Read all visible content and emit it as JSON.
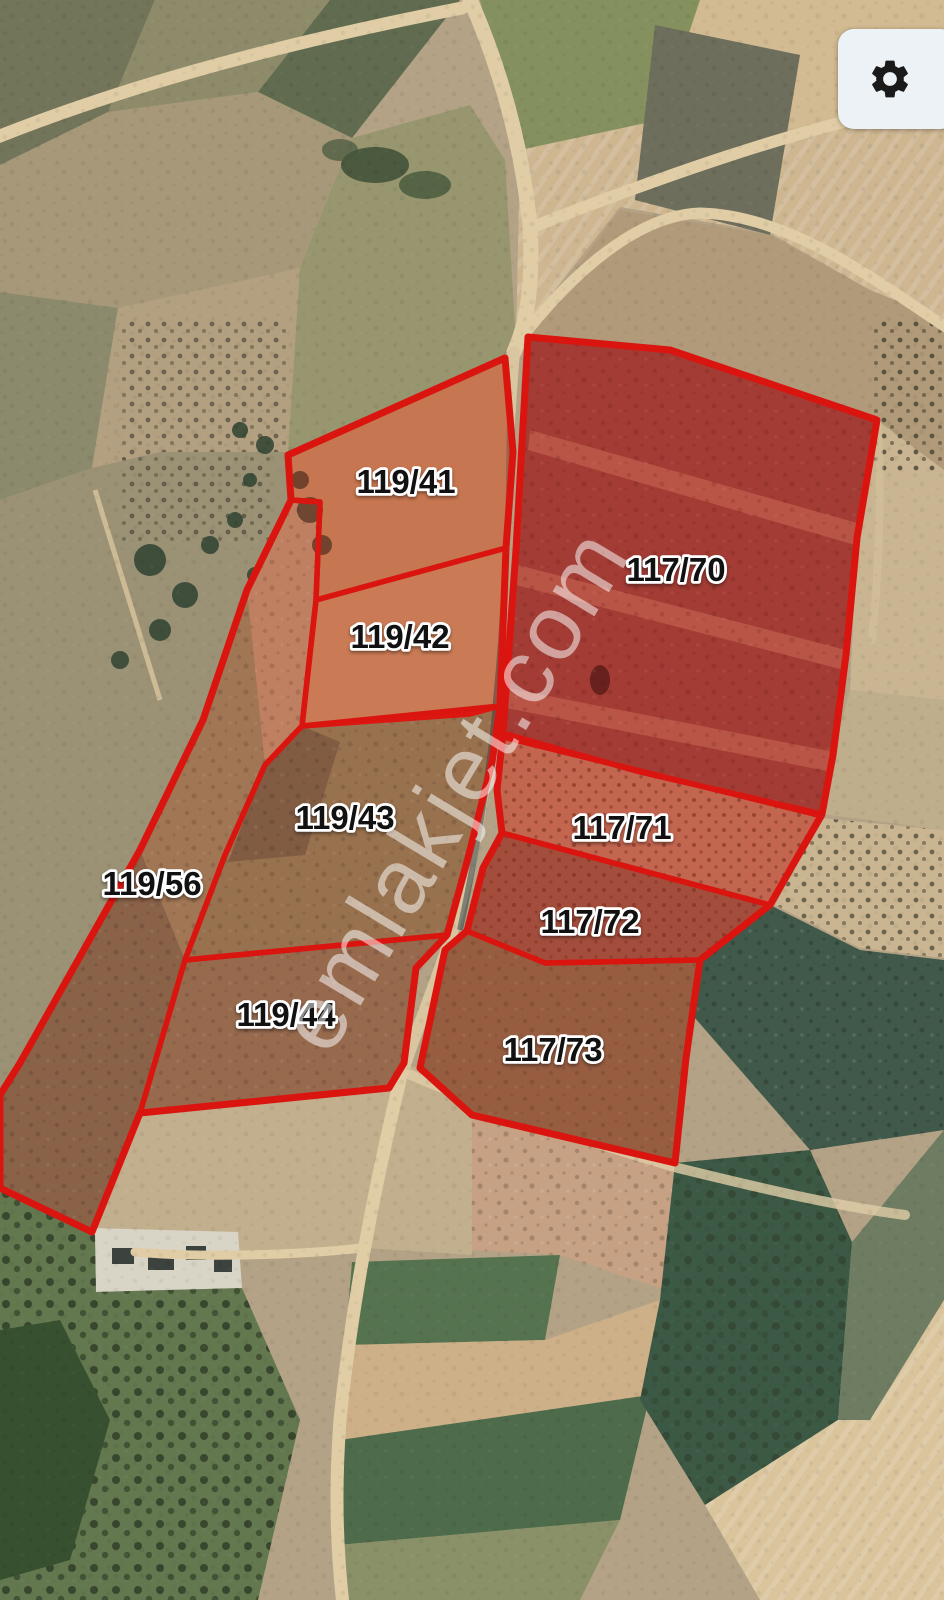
{
  "map": {
    "watermark": "emlakjet.com",
    "watermark_color": "#ffffff",
    "outline_color": "#da1510",
    "label_text_color": "#111111",
    "label_outline_color": "#ffffff",
    "parcels": [
      {
        "label": "119/41"
      },
      {
        "label": "119/42"
      },
      {
        "label": "119/43"
      },
      {
        "label": "119/56"
      },
      {
        "label": "119/44"
      },
      {
        "label": "117/70"
      },
      {
        "label": "117/71"
      },
      {
        "label": "117/72"
      },
      {
        "label": "117/73"
      }
    ]
  },
  "controls": {
    "settings_button": {
      "icon": "gear-icon"
    }
  }
}
